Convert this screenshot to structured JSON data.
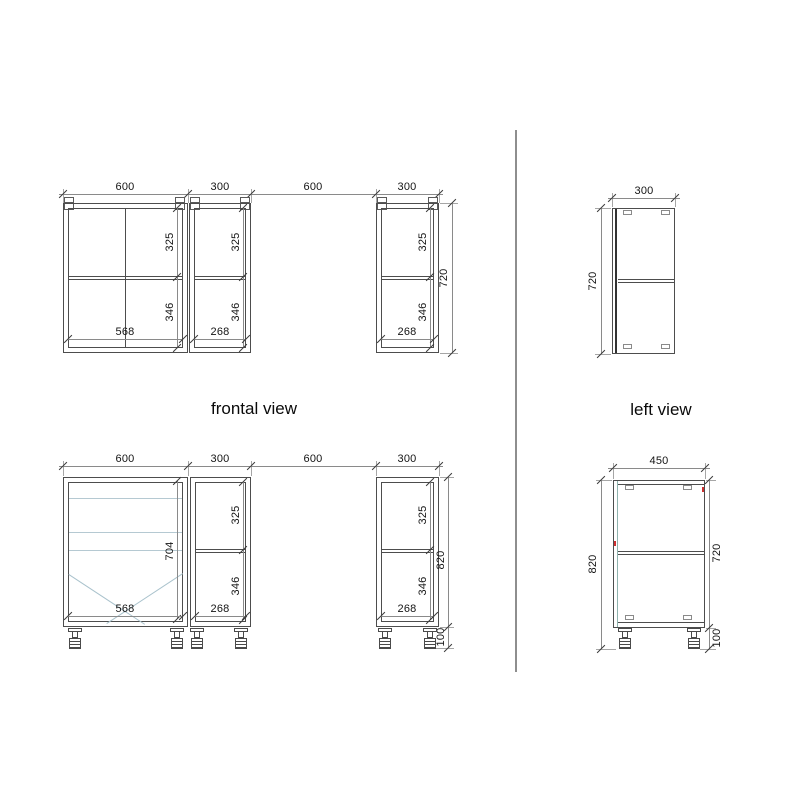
{
  "view_labels": {
    "frontal": "frontal view",
    "left": "left view"
  },
  "frontal_wall": {
    "width_dims": [
      "600",
      "300",
      "600",
      "300"
    ],
    "cab600": {
      "upper": "325",
      "lower": "346",
      "inner_width": "568"
    },
    "cab300a": {
      "upper": "325",
      "lower": "346",
      "inner_width": "268"
    },
    "cab300b": {
      "upper": "325",
      "lower": "346",
      "inner_width": "268"
    },
    "height": "720"
  },
  "left_wall": {
    "depth": "300",
    "height": "720"
  },
  "frontal_base": {
    "width_dims": [
      "600",
      "300",
      "600",
      "300"
    ],
    "cab600": {
      "front_height": "704",
      "inner_width": "568"
    },
    "cab300a": {
      "upper": "325",
      "lower": "346",
      "inner_width": "268"
    },
    "cab300b": {
      "upper": "325",
      "lower": "346",
      "inner_width": "268"
    },
    "total_height": "820",
    "plinth_height": "100"
  },
  "left_base": {
    "depth": "450",
    "total_height": "820",
    "body_height": "720",
    "plinth_height": "100"
  },
  "colors": {
    "outline": "#4d4d4d",
    "dimension": "#8a8a8a",
    "interior_light": "#b5c9d2",
    "front_edge_teal": "#8fb3ae",
    "marker_red": "#cc3030"
  }
}
